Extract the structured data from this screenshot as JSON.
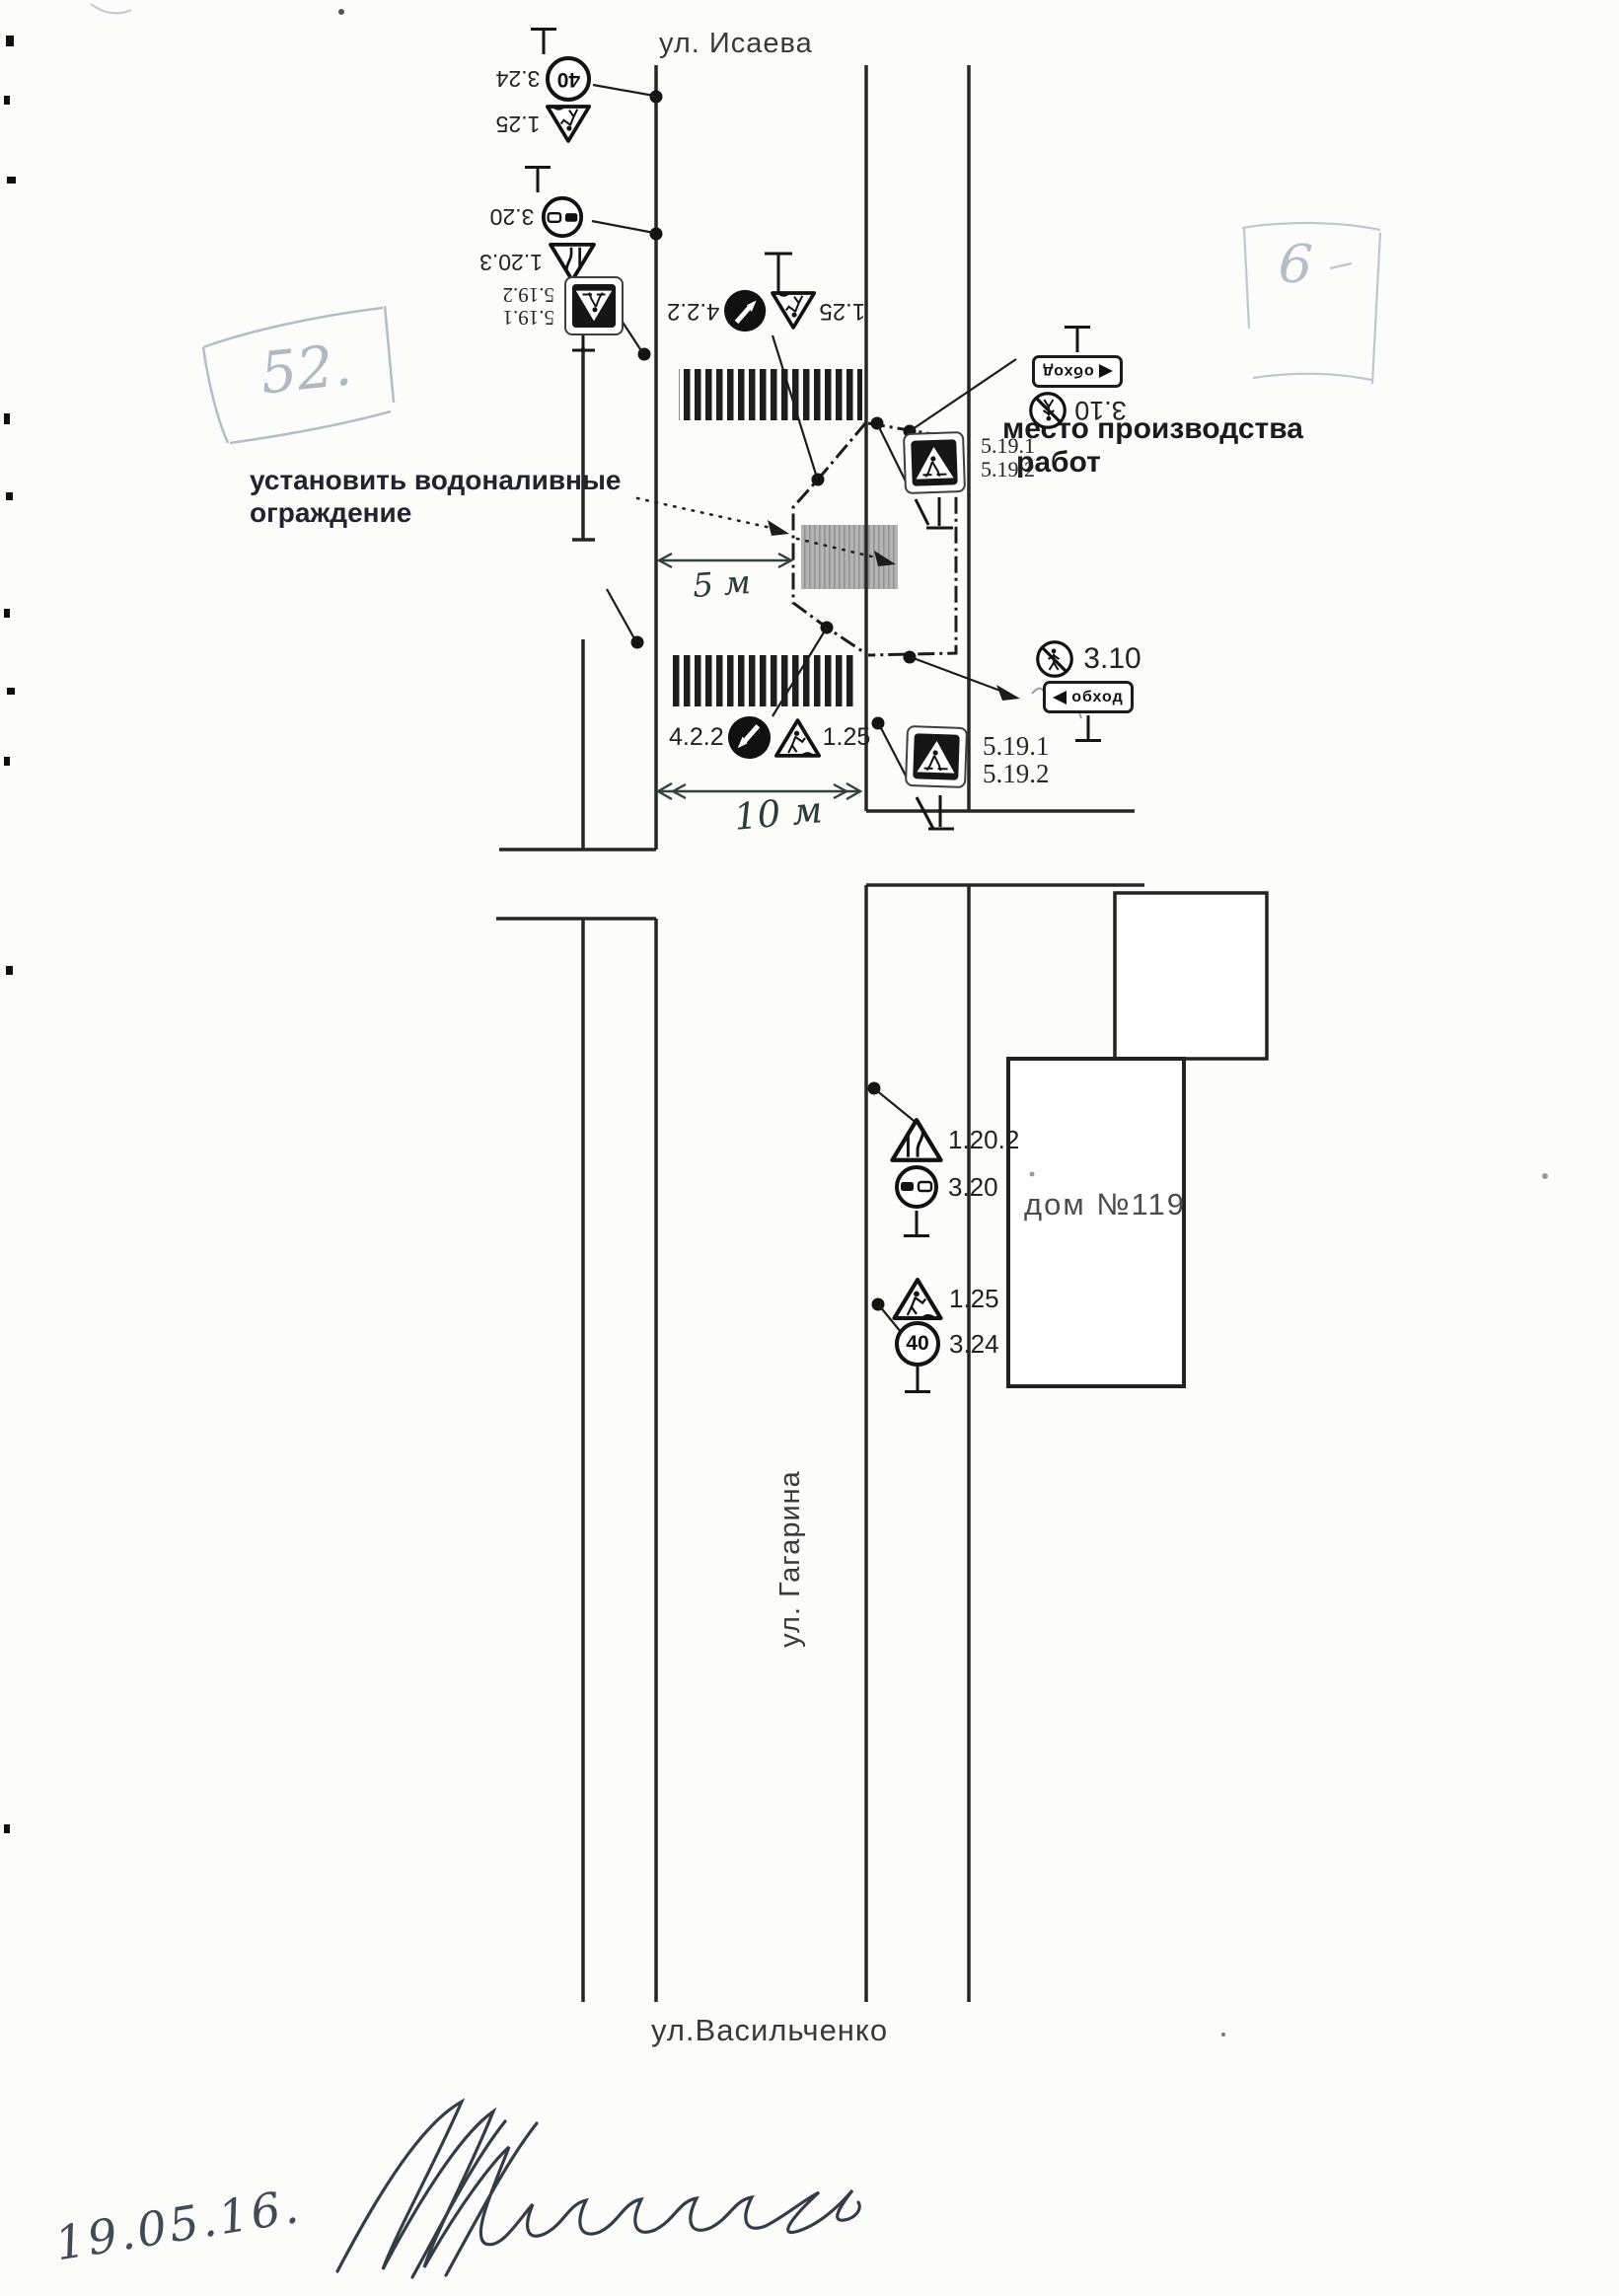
{
  "streets": {
    "isaeva": "ул. Исаева",
    "gagarina": "ул. Гагарина",
    "vasilchenko": "ул.Васильченко"
  },
  "annotations": {
    "install_line1": "установить водоналивные",
    "install_line2": "ограждение",
    "worksite_line1": "место производства",
    "worksite_line2": "работ",
    "house": "дом №119",
    "dim_5m": "5 м",
    "dim_10m": "10 м",
    "date": "19.05.16.",
    "pencil_left": "52.",
    "pencil_right": "6"
  },
  "signs": {
    "speed_40": "40",
    "code_3_24": "3.24",
    "code_1_25": "1.25",
    "code_3_20": "3.20",
    "code_1_20_3": "1.20.3",
    "code_1_20_2": "1.20.2",
    "code_5_19_1": "5.19.1",
    "code_5_19_2": "5.19.2",
    "code_4_2_2": "4.2.2",
    "code_3_10": "3.10",
    "detour_plate": "обход"
  }
}
